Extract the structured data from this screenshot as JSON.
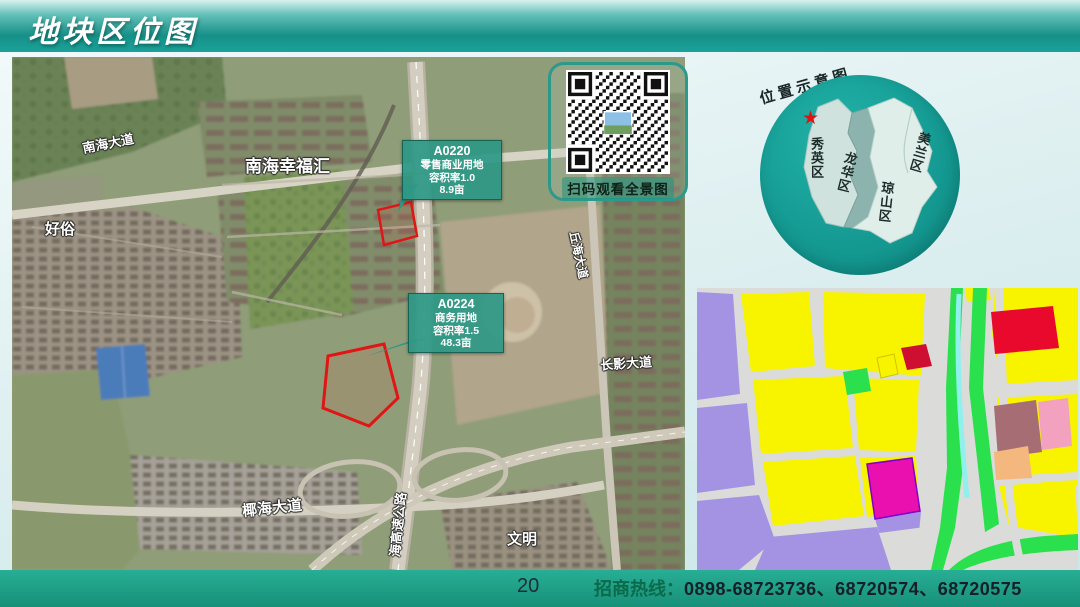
{
  "header": {
    "title": "地块区位图"
  },
  "satellite_map": {
    "road_labels": {
      "nanhai_dadao": "南海大道",
      "qiuhai_dadao": "丘海大道",
      "changying_dadao": "长影大道",
      "yehai_dadao": "椰海大道",
      "expressway": "海高速公路"
    },
    "place_labels": {
      "nanhai_xingfuhui": "南海幸福汇",
      "haosu": "好俗",
      "wenming": "文明"
    },
    "plots": [
      {
        "id": "A0220",
        "land_use": "零售商业用地",
        "plot_ratio": "容积率1.0",
        "area": "8.9亩"
      },
      {
        "id": "A0224",
        "land_use": "商务用地",
        "plot_ratio": "容积率1.5",
        "area": "48.3亩"
      }
    ],
    "plot_outline_color": "#e01515",
    "callout_color": "#2c9885",
    "qr_caption": "扫码观看全景图"
  },
  "location_diagram": {
    "title": "位置示意图",
    "districts": [
      {
        "name": "秀英区"
      },
      {
        "name": "龙华区"
      },
      {
        "name": "美兰区"
      },
      {
        "name": "琼山区"
      }
    ],
    "marker": "★",
    "marker_color": "#e31212",
    "circle_color": "#17a096"
  },
  "planning_map": {
    "palette": {
      "residential_purple": "#a493e2",
      "mixed_yellow": "#f8f400",
      "park_green": "#2ae04c",
      "road_gray": "#dbdbd9",
      "water_cyan": "#8ff0ec",
      "commercial_red": "#e8092c",
      "deep_red": "#cf0f32",
      "magenta": "#ea10b0",
      "pink": "#f2a2be",
      "brown": "#a66d75",
      "orange": "#f4b77e"
    }
  },
  "footer": {
    "page_number": "20",
    "hotline_label": "招商热线：",
    "hotline_numbers": "0898-68723736、68720574、68720575"
  }
}
